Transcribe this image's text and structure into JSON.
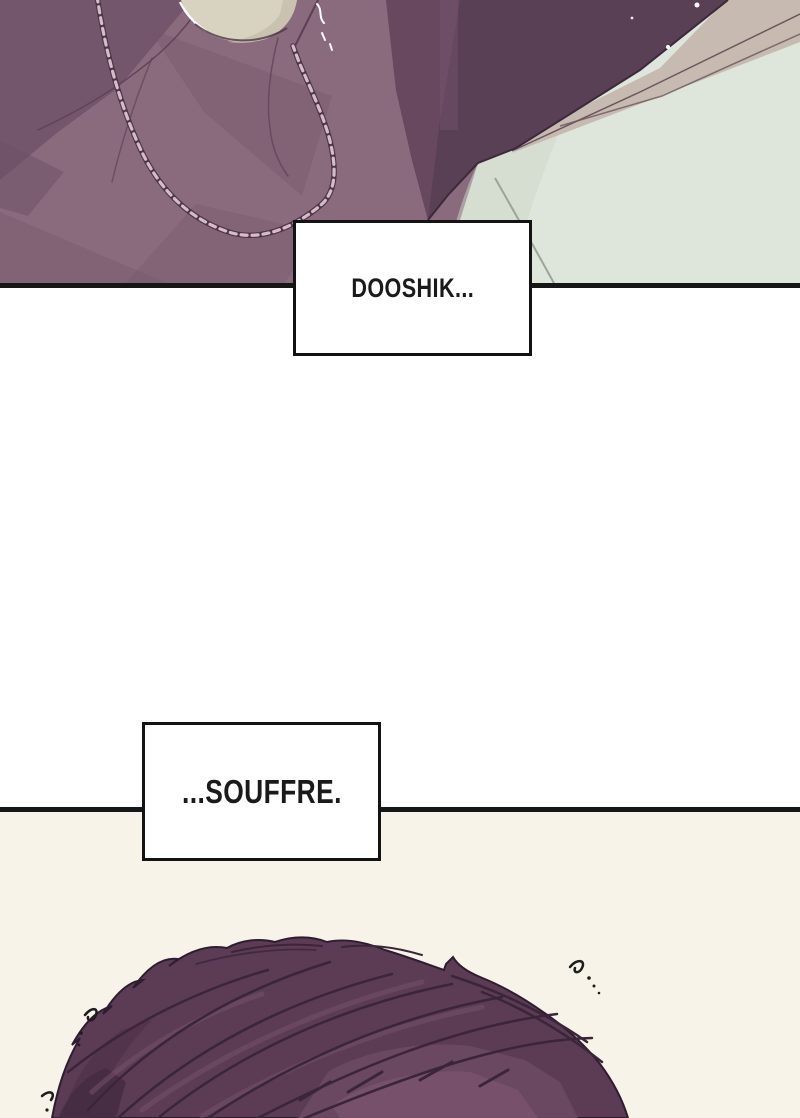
{
  "dialogue": [
    {
      "id": "bubble-1",
      "text": "DOOSHIK..."
    },
    {
      "id": "bubble-2",
      "text": "...SOUFFRE."
    }
  ],
  "palette": {
    "panel_border": "#161616",
    "speech_text": "#1a1a1a",
    "white_background": "#ffffff",
    "cream_background": "#f7f3e8",
    "clothing_base": "#8a6a7d",
    "clothing_shadow": "#6f5268",
    "neck_skin": "#d8d3c0",
    "dark_hair_silhouette": "#594054",
    "bedding_mint": "#dee5da",
    "bedding_fold": "#9aa795",
    "blanket_edge_beige": "#c7bab1",
    "chain_dark": "#4e3549",
    "chain_light": "#d4bcc8",
    "hair_base": "#5b3c54",
    "hair_strand": "#3a2539",
    "hair_highlight": "#7a536e",
    "sparkle": "#ffffff",
    "tremble_mark": "#1d1d1d"
  }
}
